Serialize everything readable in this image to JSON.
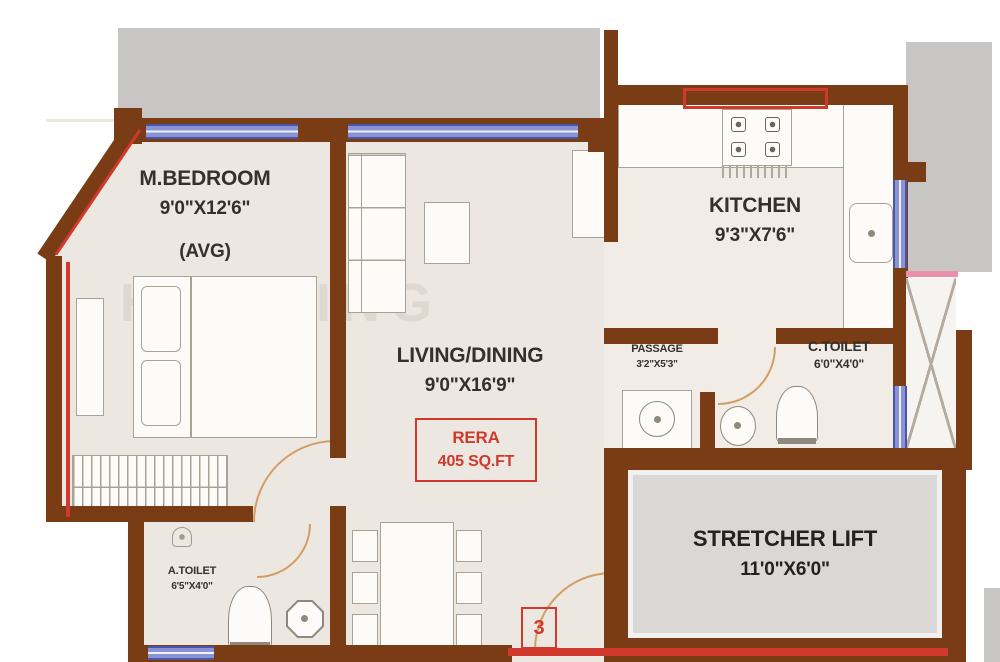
{
  "watermark": "HOUSING",
  "rooms": {
    "bedroom": {
      "name": "M.BEDROOM",
      "dim": "9'0\"X12'6\"",
      "note": "(AVG)"
    },
    "living": {
      "name": "LIVING/DINING",
      "dim": "9'0\"X16'9\""
    },
    "kitchen": {
      "name": "KITCHEN",
      "dim": "9'3\"X7'6\""
    },
    "passage": {
      "name": "PASSAGE",
      "dim": "3'2\"X5'3\""
    },
    "c_toilet": {
      "name": "C.TOILET",
      "dim": "6'0\"X4'0\""
    },
    "a_toilet": {
      "name": "A.TOILET",
      "dim": "6'5\"X4'0\""
    },
    "stretcher_lift": {
      "name": "STRETCHER LIFT",
      "dim": "11'0\"X6'0\""
    }
  },
  "rera_badge": {
    "line1": "RERA",
    "line2": "405 SQ.FT"
  },
  "flat_number": "3",
  "colors": {
    "wall": "#7a3c15",
    "floor": "#ece7e0",
    "kitchen_floor": "#f1ece5",
    "exterior": "#c7c6c4",
    "window_blue": "#8a93d6",
    "window_dark": "#4a55a8",
    "accent_red": "#d0392b",
    "pink_line": "#ef8fae",
    "lift_floor": "#d9d8d6",
    "door_arc": "#d29e66"
  }
}
